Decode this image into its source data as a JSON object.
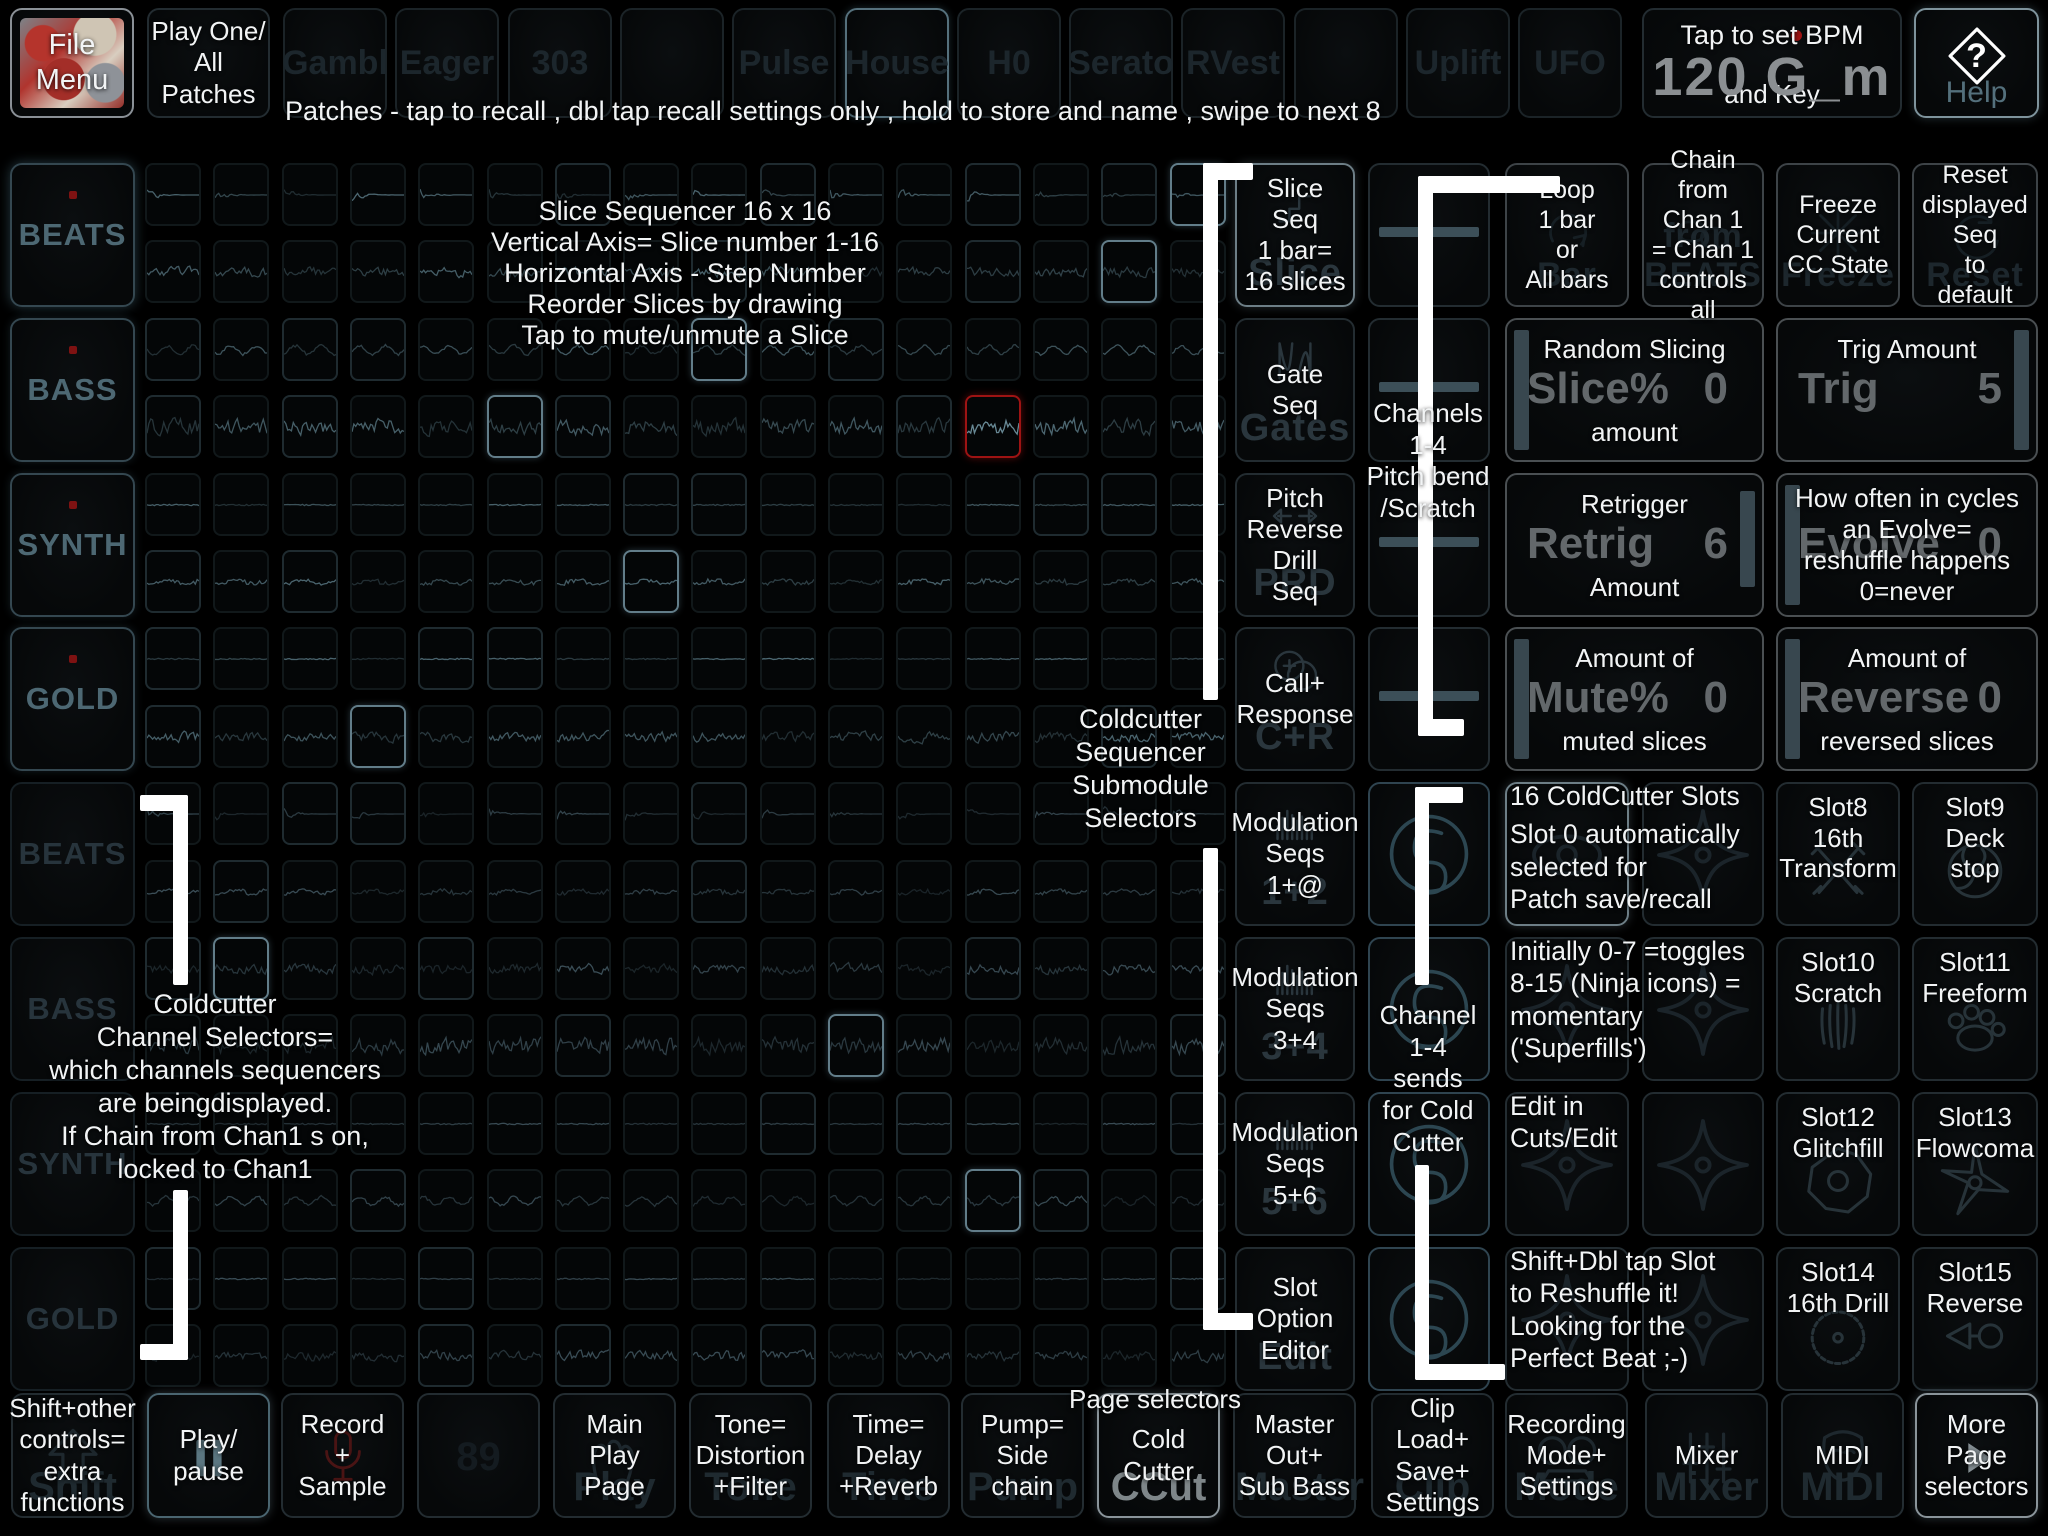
{
  "top_bar": {
    "file_menu": "File Menu",
    "play_one_lines": [
      "Play One/",
      "All",
      "Patches"
    ],
    "patches_hint": "Patches - tap to recall , dbl tap recall settings only , hold to store and name , swipe to next 8",
    "patch_slots": [
      "Gambl",
      "Eager",
      "303",
      "",
      "Pulse",
      "House",
      "H0",
      "Serato",
      "RVest",
      "",
      "Uplift",
      "UFO"
    ],
    "active_patch_index": 5,
    "bpm_hint_top": "Tap to set BPM",
    "bpm_value": "120 G_m",
    "bpm_hint_bottom": "and Key",
    "help": "Help"
  },
  "grid_annotation": [
    "Slice Sequencer 16 x 16",
    "Vertical Axis= Slice number 1-16",
    "Horizontal Axis - Step Number",
    "Reorder Slices by drawing",
    "Tap to mute/unmute a Slice"
  ],
  "channel_selectors": {
    "labels": [
      "BEATS",
      "BASS",
      "SYNTH",
      "GOLD",
      "BEATS",
      "BASS",
      "SYNTH",
      "GOLD"
    ],
    "note": [
      "Coldcutter",
      "Channel Selectors=",
      "which channels  sequencers",
      "are beingdisplayed.",
      "If Chain from Chan1 s on,",
      "locked to Chan1"
    ]
  },
  "grid": {
    "rows": 16,
    "cols": 16,
    "row_styles": [
      "decay",
      "noisy",
      "wavy",
      "loud",
      "line",
      "gentle",
      "line",
      "noisy",
      "decay",
      "gentle",
      "noisy",
      "loud",
      "line",
      "wavy",
      "line",
      "noisy"
    ],
    "red_cell": [
      3,
      12
    ],
    "highlight_cells": [
      [
        0,
        15
      ],
      [
        1,
        14
      ],
      [
        2,
        8
      ],
      [
        3,
        5
      ],
      [
        5,
        7
      ],
      [
        7,
        3
      ],
      [
        10,
        1
      ],
      [
        11,
        10
      ],
      [
        13,
        12
      ]
    ]
  },
  "submodule_selectors": {
    "note": [
      "Coldcutter",
      "Sequencer",
      "Submodule",
      "Selectors"
    ],
    "buttons": [
      {
        "overlay": [
          "Slice",
          "Seq",
          "1 bar=",
          "16 slices"
        ],
        "ghost": "Slice",
        "icon": "steps"
      },
      {
        "overlay": [
          "Gate",
          "Seq"
        ],
        "ghost": "Gates",
        "icon": "gates"
      },
      {
        "overlay": [
          "Pitch",
          "Reverse",
          "Drill",
          "Seq"
        ],
        "ghost": "PRD",
        "icon": "arrows-lr"
      },
      {
        "overlay": [
          "Call+",
          "Response"
        ],
        "ghost": "C+R",
        "icon": "bubbles"
      },
      {
        "overlay": [
          "Modulation",
          "Seqs",
          "1+@"
        ],
        "ghost": "1+2",
        "icon": "bars"
      },
      {
        "overlay": [
          "Modulation",
          "Seqs",
          "3+4"
        ],
        "ghost": "3+4",
        "icon": "bars"
      },
      {
        "overlay": [
          "Modulation",
          "Seqs",
          "5+6"
        ],
        "ghost": "5+6",
        "icon": "bars"
      },
      {
        "overlay": [
          "Slot",
          "Option",
          "Editor"
        ],
        "ghost": "Edit",
        "icon": ""
      }
    ]
  },
  "channel_strip": {
    "caption_top": [
      "Channels",
      "1-4",
      "Pitch bend",
      "/Scratch"
    ],
    "caption_bottom": [
      "Channel",
      "1-4",
      "sends",
      "for Cold",
      "Cutter"
    ]
  },
  "panels": {
    "row1": [
      {
        "overlay": [
          "Loop",
          "1 bar",
          "or",
          "All bars"
        ],
        "ghost": "Bar",
        "icon": "loop"
      },
      {
        "overlay": [
          "Chain",
          "from",
          "Chan 1",
          "= Chan 1",
          "controls all"
        ],
        "ghost": "from BEATS",
        "icon": "chain"
      },
      {
        "overlay": [
          "Freeze",
          "Current",
          "CC State"
        ],
        "ghost": "Freeze",
        "icon": "freeze"
      },
      {
        "overlay": [
          "Reset",
          "displayed",
          "Seq",
          "to",
          "default"
        ],
        "ghost": "Reset",
        "icon": "reset"
      }
    ],
    "wide": [
      {
        "top": "Random Slicing",
        "ghost_label": "Slice%",
        "ghost_value": "0",
        "bottom": "amount",
        "slider": "left"
      },
      {
        "top": "Trig Amount",
        "ghost_label": "Trig",
        "ghost_value": "5",
        "bottom": "",
        "slider": "right"
      },
      {
        "top": "Retrigger",
        "ghost_label": "Retrig",
        "ghost_value": "6",
        "bottom": "Amount",
        "slider": "right-part"
      },
      {
        "lines": [
          "How often in cycles",
          "an Evolve=",
          "reshuffle happens",
          "0=never"
        ],
        "ghost_label": "Evolve",
        "ghost_value": "0",
        "slider": "left"
      },
      {
        "top": "Amount of",
        "ghost_label": "Mute%",
        "ghost_value": "0",
        "bottom": "muted slices",
        "slider": "left"
      },
      {
        "top": "Amount of",
        "ghost_label": "Reverse",
        "ghost_value": "0",
        "bottom": "reversed slices",
        "slider": "left"
      }
    ],
    "slot_rows": [
      {
        "note": [
          "16 ColdCutter Slots",
          "Slot 0 automatically",
          "selected for",
          "Patch save/recall"
        ],
        "left_icons": [
          "eye",
          "shuriken"
        ],
        "slot0_active": true,
        "slots": [
          {
            "lines": [
              "Slot8",
              "16th",
              "Transform"
            ],
            "icon": "swords"
          },
          {
            "lines": [
              "Slot9",
              "Deck",
              "stop"
            ],
            "icon": "fan"
          }
        ]
      },
      {
        "note": [
          "Initially 0-7 =toggles",
          "8-15 (Ninja icons) =",
          "momentary",
          "('Superfills')"
        ],
        "left_icons": [
          "shuriken",
          "shuriken"
        ],
        "slots": [
          {
            "lines": [
              "Slot10",
              "Scratch"
            ],
            "icon": "claw"
          },
          {
            "lines": [
              "Slot11",
              "Freeform"
            ],
            "icon": "paw"
          }
        ]
      },
      {
        "note": [
          "Edit in",
          "Cuts/Edit"
        ],
        "left_icons": [
          "shuriken",
          "shuriken"
        ],
        "slots": [
          {
            "lines": [
              "Slot12",
              "Glitchfill"
            ],
            "icon": "hexstar"
          },
          {
            "lines": [
              "Slot13",
              "Flowcoma"
            ],
            "icon": "tristar"
          }
        ]
      },
      {
        "note": [
          "Shift+Dbl tap Slot",
          "to Reshuffle it!",
          "Looking for the",
          "Perfect Beat ;-)"
        ],
        "left_icons": [
          "shuriken",
          "shuriken"
        ],
        "slots": [
          {
            "lines": [
              "Slot14",
              "16th Drill"
            ],
            "icon": "saw"
          },
          {
            "lines": [
              "Slot15",
              "Reverse"
            ],
            "icon": "arrowring"
          }
        ]
      }
    ]
  },
  "bottom_bar": {
    "page_selectors_label": "Page selectors",
    "buttons": [
      {
        "name": "shift",
        "overlay": [
          "Shift+other",
          "controls=",
          "extra",
          "functions"
        ],
        "ghost": "Shift",
        "icon": "shift",
        "active": false
      },
      {
        "name": "play-pause",
        "overlay": [
          "Play/",
          "pause"
        ],
        "ghost": "",
        "icon": "pause",
        "active": true
      },
      {
        "name": "record-sample",
        "overlay": [
          "Record",
          "+",
          "Sample"
        ],
        "ghost": "",
        "icon": "mic",
        "active": false
      },
      {
        "name": "pad-89",
        "overlay": [],
        "ghost": "89",
        "icon": "",
        "active": false
      },
      {
        "name": "main-play-page",
        "overlay": [
          "Main",
          "Play",
          "Page"
        ],
        "ghost": "Play",
        "icon": "hands",
        "active": false
      },
      {
        "name": "tone",
        "overlay": [
          "Tone=",
          "Distortion",
          "+Filter"
        ],
        "ghost": "Tone",
        "icon": "",
        "active": false
      },
      {
        "name": "time",
        "overlay": [
          "Time=",
          "Delay",
          "+Reverb"
        ],
        "ghost": "Time",
        "icon": "",
        "active": false
      },
      {
        "name": "pump",
        "overlay": [
          "Pump=",
          "Side",
          "chain"
        ],
        "ghost": "Pump",
        "icon": "",
        "active": false
      },
      {
        "name": "cold-cutter",
        "overlay": [
          "Cold",
          "Cutter"
        ],
        "ghost": "CCut",
        "icon": "",
        "active": true,
        "bright_ghost": true
      },
      {
        "name": "master",
        "overlay": [
          "Master",
          "Out+",
          "Sub Bass"
        ],
        "ghost": "Master",
        "icon": "",
        "active": false
      },
      {
        "name": "clip",
        "overlay": [
          "Clip",
          "Load+",
          "Save+",
          "Settings"
        ],
        "ghost": "Clip",
        "icon": "",
        "active": false
      },
      {
        "name": "recording-mode",
        "overlay": [
          "Recording",
          "Mode+",
          "Settings"
        ],
        "ghost": "Mode",
        "icon": "reel",
        "active": false
      },
      {
        "name": "mixer",
        "overlay": [
          "Mixer"
        ],
        "ghost": "Mixer",
        "icon": "faders",
        "active": false
      },
      {
        "name": "midi",
        "overlay": [
          "MIDI"
        ],
        "ghost": "MIDI",
        "icon": "mask",
        "active": false
      },
      {
        "name": "more-pages",
        "overlay": [
          "More",
          "Page",
          "selectors"
        ],
        "ghost": "",
        "icon": "arrow-right",
        "active": true
      }
    ]
  },
  "colors": {
    "accent_teal": "#4d6873",
    "white": "#f2f4f5",
    "red_cell": "#9e1313",
    "slider": "#38474f",
    "ghost": "#1f2a30",
    "bpm_grey": "#8b8f92"
  }
}
